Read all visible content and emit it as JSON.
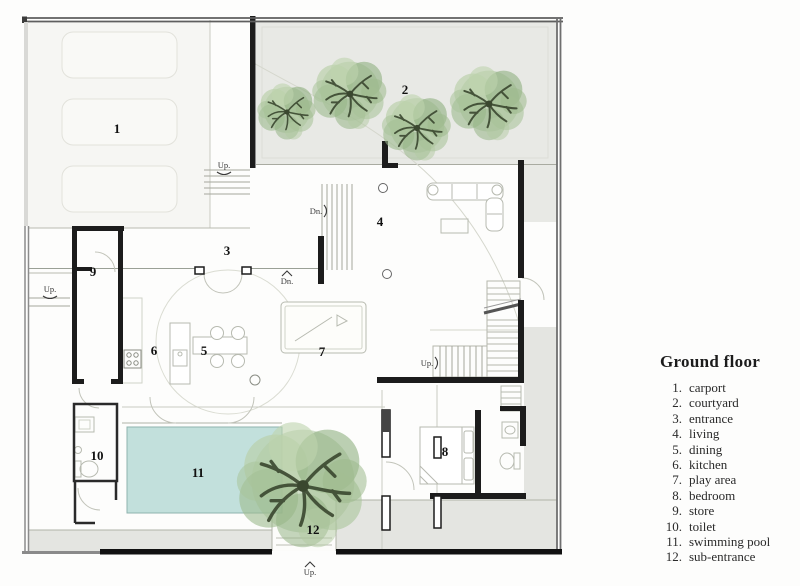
{
  "plan": {
    "room_numbers": {
      "r1": "1",
      "r2": "2",
      "r3": "3",
      "r4": "4",
      "r5": "5",
      "r6": "6",
      "r7": "7",
      "r8": "8",
      "r9": "9",
      "r10": "10",
      "r11": "11",
      "r12": "12"
    },
    "direction_labels": {
      "up_carport": "Up.",
      "up_side": "Up.",
      "up_stair": "Up.",
      "up_sub": "Up.",
      "dn_stair": "Dn.",
      "dn_hall": "Dn."
    },
    "colors": {
      "courtyard": "#e8e9e5",
      "terrace": "#e4e5e1",
      "carport": "#f6f6f3",
      "pool": "#c2e0dc",
      "wall": "#1c1c1c",
      "boundary": "#6f6f6f",
      "tree_foliage": "#9dba8d",
      "tree_branch": "#3a472f"
    }
  },
  "legend": {
    "title": "Ground floor",
    "items": [
      {
        "number": "1.",
        "label": "carport"
      },
      {
        "number": "2.",
        "label": "courtyard"
      },
      {
        "number": "3.",
        "label": "entrance"
      },
      {
        "number": "4.",
        "label": "living"
      },
      {
        "number": "5.",
        "label": "dining"
      },
      {
        "number": "6.",
        "label": "kitchen"
      },
      {
        "number": "7.",
        "label": "play area"
      },
      {
        "number": "8.",
        "label": "bedroom"
      },
      {
        "number": "9.",
        "label": "store"
      },
      {
        "number": "10.",
        "label": "toilet"
      },
      {
        "number": "11.",
        "label": "swimming pool"
      },
      {
        "number": "12.",
        "label": "sub-entrance"
      }
    ]
  }
}
